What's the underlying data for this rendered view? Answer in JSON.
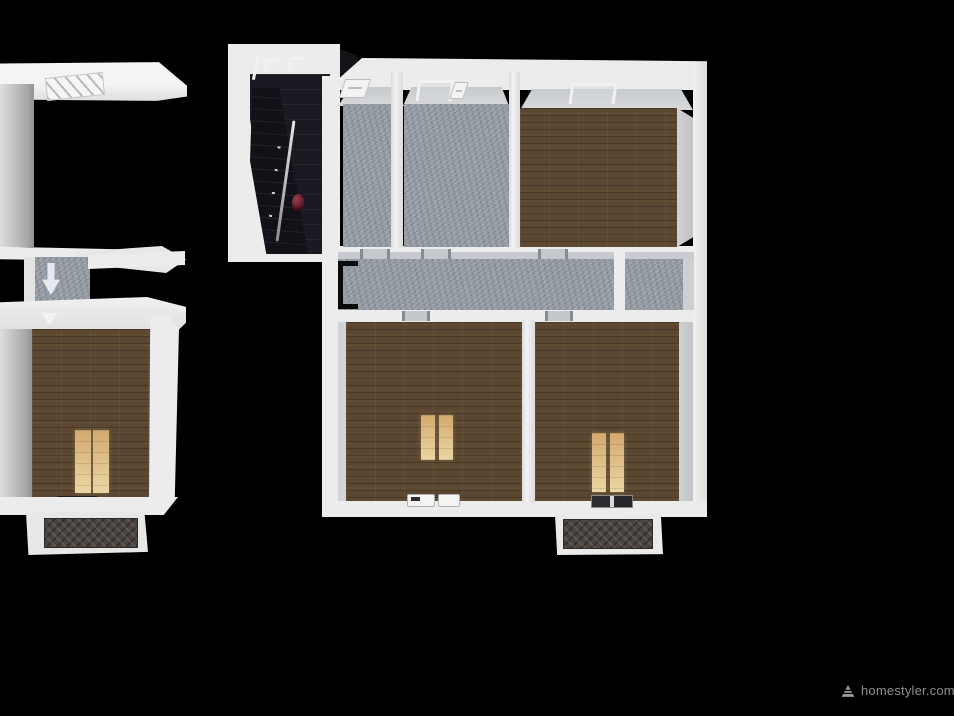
{
  "watermark": {
    "text": "homestyler.com",
    "logo_icon": "homestyler-pyramid-icon"
  },
  "palette": {
    "background": "#000000",
    "wall": "#ececec",
    "wall_shadow": "#c7cacd",
    "stone_floor": "#99a0a8",
    "wood_floor": "#5b4731",
    "sunlight": "#ecd6a4",
    "sunlight_deep": "#d2a96e",
    "porch_tile": "#4a4440",
    "stair_dark": "#1b1a22",
    "stair_darker": "#121118",
    "railing": "#e8e8e8",
    "knob_red": "#6b2430",
    "door_black": "#0a0a0a",
    "watermark_text": "#8f8f8f"
  },
  "rooms": [
    {
      "id": "left-bedroom",
      "floor": "wood"
    },
    {
      "id": "left-corridor",
      "floor": "stone"
    },
    {
      "id": "left-porch",
      "floor": "dark-herringbone-tile"
    },
    {
      "id": "stairwell",
      "floor": "dark-stairs"
    },
    {
      "id": "main-room-top-left",
      "floor": "stone"
    },
    {
      "id": "main-room-top-middle",
      "floor": "stone"
    },
    {
      "id": "main-bedroom-top-right",
      "floor": "wood"
    },
    {
      "id": "main-hallway",
      "floor": "stone"
    },
    {
      "id": "main-closet-right",
      "floor": "stone"
    },
    {
      "id": "main-bedroom-bottom-left",
      "floor": "wood"
    },
    {
      "id": "main-bedroom-bottom-right",
      "floor": "wood"
    },
    {
      "id": "main-porch",
      "floor": "dark-herringbone-tile"
    }
  ]
}
